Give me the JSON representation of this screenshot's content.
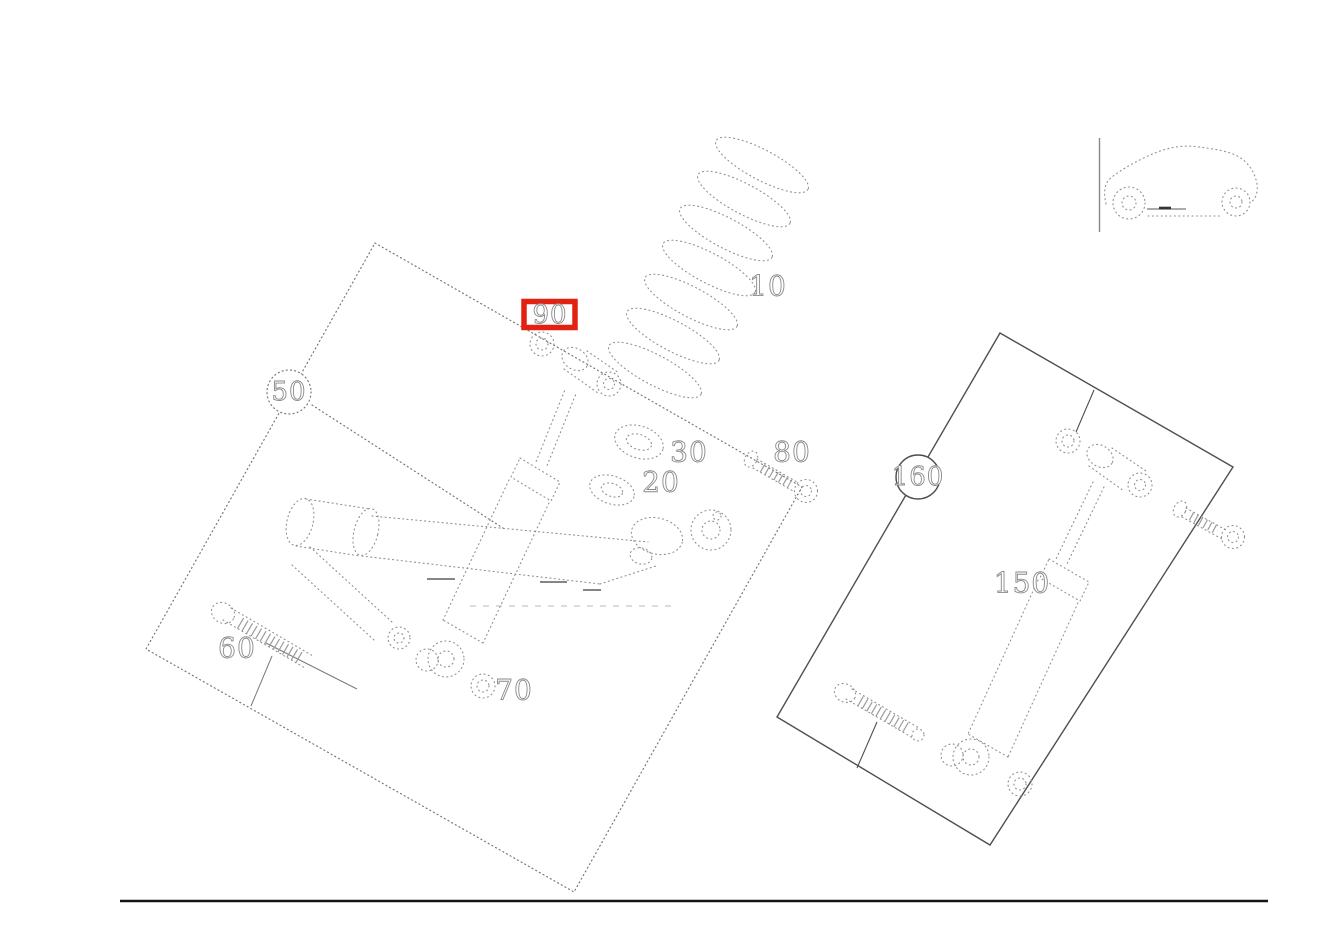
{
  "diagram": {
    "callouts": {
      "n10": "10",
      "n20": "20",
      "n30": "30",
      "n50": "50",
      "n60": "60",
      "n70": "70",
      "n80": "80",
      "n90": "90",
      "n150": "150",
      "n160": "160"
    },
    "highlighted_callout": "90",
    "colors": {
      "highlight_box": "#e32113",
      "sketch_line": "#8f8f8f",
      "panel_solid_line": "#4f4f4f",
      "footer_rule": "#141414"
    },
    "icons": {
      "vehicle_orientation": "car-side-outline-icon"
    }
  }
}
